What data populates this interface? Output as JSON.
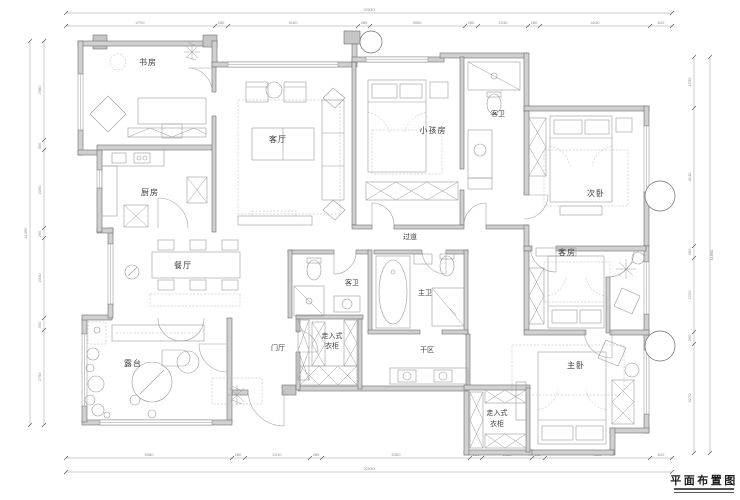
{
  "title": "平面布置图",
  "rooms": {
    "study": "书房",
    "kitchen": "厨房",
    "dining": "餐厅",
    "living": "客厅",
    "kids_room": "小孩房",
    "guest_bath_top": "客卫",
    "second_bedroom": "次卧",
    "corridor": "过道",
    "guest_bath_mid": "客卫",
    "master_bath": "主卫",
    "guest_room": "客房",
    "foyer": "门厅",
    "terrace": "露台",
    "closet1_line1": "走入式",
    "closet1_line2": "衣柜",
    "dry_area": "干区",
    "master_bedroom": "主卧",
    "closet2_line1": "走入式",
    "closet2_line2": "衣柜"
  },
  "dims": {
    "top": {
      "total": "22030",
      "segments": [
        "4700",
        "280",
        "5160",
        "280",
        "3950",
        "280",
        "2240",
        "280",
        "4240",
        "620"
      ]
    },
    "bottom": {
      "total": "22030",
      "segments": [
        "5980",
        "280",
        "2410",
        "280",
        "5300",
        "280",
        "1980",
        "280",
        "4620",
        "620"
      ]
    },
    "left": {
      "total": "11390",
      "segments": [
        "2980",
        "350",
        "2290",
        "290",
        "2340",
        "350",
        "2790"
      ]
    },
    "right": {
      "total": "11880",
      "segments": [
        "1530",
        "4140",
        "360",
        "2220",
        "360",
        "3270"
      ]
    }
  },
  "colors": {
    "wall_fill": "#d0d0d0",
    "line_gray": "#9b9b9b",
    "text_dark": "#3c3c3c"
  }
}
